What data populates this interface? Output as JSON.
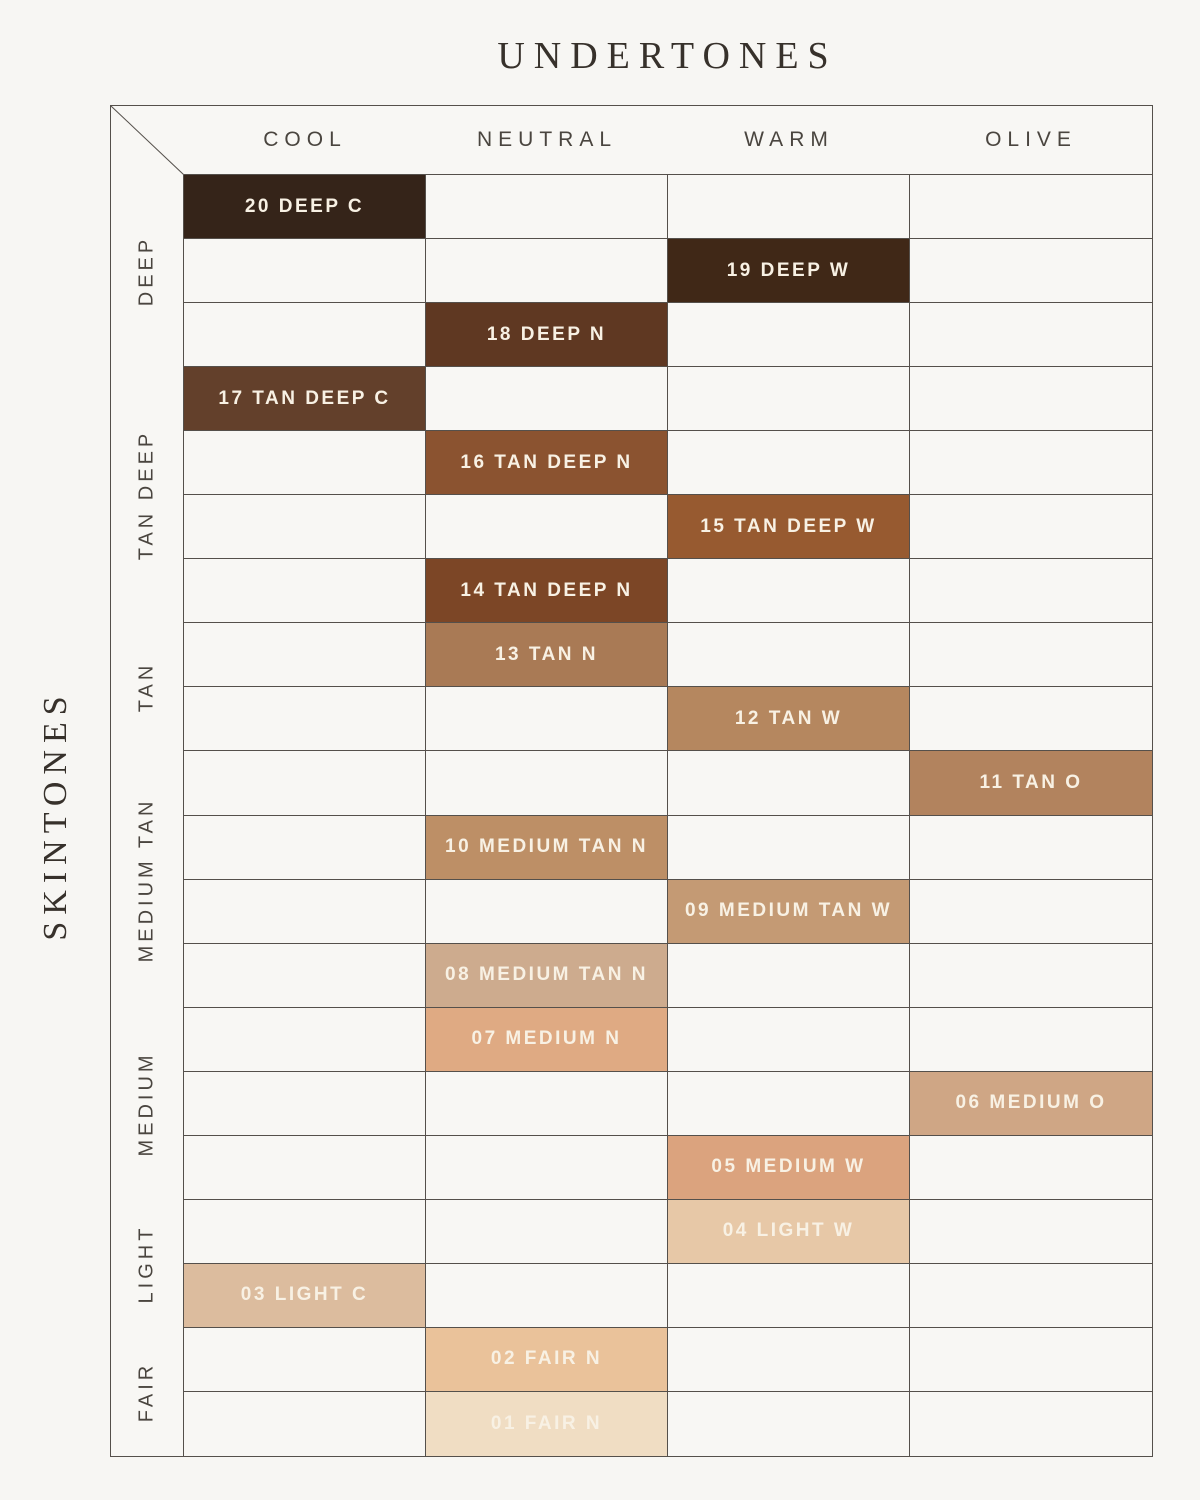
{
  "title": "UNDERTONES",
  "side_label": "SKINTONES",
  "colors": {
    "background": "#f7f6f3",
    "grid_line": "#55504b",
    "header_text": "#4a453f",
    "title_text": "#37312b",
    "swatch_text": "#f8f1e4"
  },
  "chart_data": {
    "type": "matrix",
    "title": "UNDERTONES",
    "columns_axis_label": "UNDERTONES",
    "rows_axis_label": "SKINTONES",
    "col_categories": [
      "COOL",
      "NEUTRAL",
      "WARM",
      "OLIVE"
    ],
    "row_groups": [
      {
        "label": "DEEP",
        "span": 3
      },
      {
        "label": "TAN DEEP",
        "span": 4
      },
      {
        "label": "TAN",
        "span": 2
      },
      {
        "label": "MEDIUM TAN",
        "span": 4
      },
      {
        "label": "MEDIUM",
        "span": 3
      },
      {
        "label": "LIGHT",
        "span": 2
      },
      {
        "label": "FAIR",
        "span": 2
      }
    ],
    "shades": [
      {
        "row": 1,
        "label": "20 DEEP C",
        "undertone": "COOL",
        "color": "#352419"
      },
      {
        "row": 2,
        "label": "19 DEEP W",
        "undertone": "WARM",
        "color": "#402817"
      },
      {
        "row": 3,
        "label": "18 DEEP N",
        "undertone": "NEUTRAL",
        "color": "#5f3822"
      },
      {
        "row": 4,
        "label": "17 TAN DEEP C",
        "undertone": "COOL",
        "color": "#63402b"
      },
      {
        "row": 5,
        "label": "16 TAN DEEP N",
        "undertone": "NEUTRAL",
        "color": "#8b5330"
      },
      {
        "row": 6,
        "label": "15 TAN DEEP W",
        "undertone": "WARM",
        "color": "#975a30"
      },
      {
        "row": 7,
        "label": "14 TAN DEEP N",
        "undertone": "NEUTRAL",
        "color": "#7c4626"
      },
      {
        "row": 8,
        "label": "13 TAN N",
        "undertone": "NEUTRAL",
        "color": "#a97a55"
      },
      {
        "row": 9,
        "label": "12 TAN W",
        "undertone": "WARM",
        "color": "#b5875f"
      },
      {
        "row": 10,
        "label": "11 TAN O",
        "undertone": "OLIVE",
        "color": "#b2835e"
      },
      {
        "row": 11,
        "label": "10 MEDIUM TAN N",
        "undertone": "NEUTRAL",
        "color": "#bd8f66"
      },
      {
        "row": 12,
        "label": "09 MEDIUM TAN W",
        "undertone": "WARM",
        "color": "#c49a74"
      },
      {
        "row": 13,
        "label": "08 MEDIUM TAN N",
        "undertone": "NEUTRAL",
        "color": "#cdab8e"
      },
      {
        "row": 14,
        "label": "07 MEDIUM N",
        "undertone": "NEUTRAL",
        "color": "#dfaa83"
      },
      {
        "row": 15,
        "label": "06 MEDIUM O",
        "undertone": "OLIVE",
        "color": "#cfa685"
      },
      {
        "row": 16,
        "label": "05 MEDIUM W",
        "undertone": "WARM",
        "color": "#dba37e"
      },
      {
        "row": 17,
        "label": "04 LIGHT W",
        "undertone": "WARM",
        "color": "#e7c8a7"
      },
      {
        "row": 18,
        "label": "03 LIGHT C",
        "undertone": "COOL",
        "color": "#dcbc9e"
      },
      {
        "row": 19,
        "label": "02 FAIR N",
        "undertone": "NEUTRAL",
        "color": "#eac29a"
      },
      {
        "row": 20,
        "label": "01 FAIR N",
        "undertone": "NEUTRAL",
        "color": "#f0ddc3"
      }
    ]
  }
}
